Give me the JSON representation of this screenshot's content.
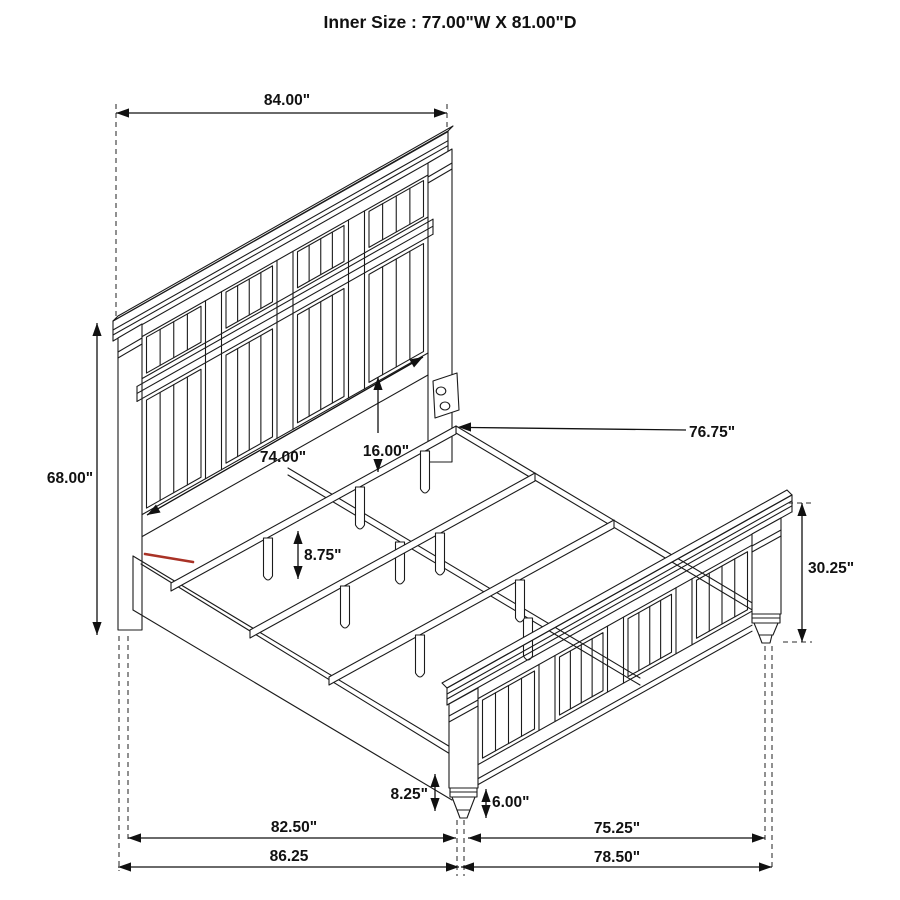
{
  "title": "Inner Size : 77.00\"W X 81.00\"D",
  "inner_size": {
    "width": "77.00\"",
    "depth": "81.00\""
  },
  "subject": "bed frame dimension drawing (headboard, footboard, side rails, slats with support legs)",
  "colors": {
    "line": "#1b1b1b",
    "accent_red": "#a93226",
    "background": "#ffffff"
  },
  "dimension_labels": {
    "top_width": "84.00\"",
    "left_height": "68.00\"",
    "inner_width": "74.00\"",
    "slat_offset": "16.00\"",
    "support_leg_height": "8.75\"",
    "rail_length": "76.75\"",
    "footboard_height": "30.25\"",
    "foot_post_height": "8.25\"",
    "foot_height": "6.00\"",
    "bottom_inner_left": "82.50\"",
    "bottom_inner_right": "75.25\"",
    "bottom_outer_left": "86.25",
    "bottom_outer_right": "78.50\""
  }
}
